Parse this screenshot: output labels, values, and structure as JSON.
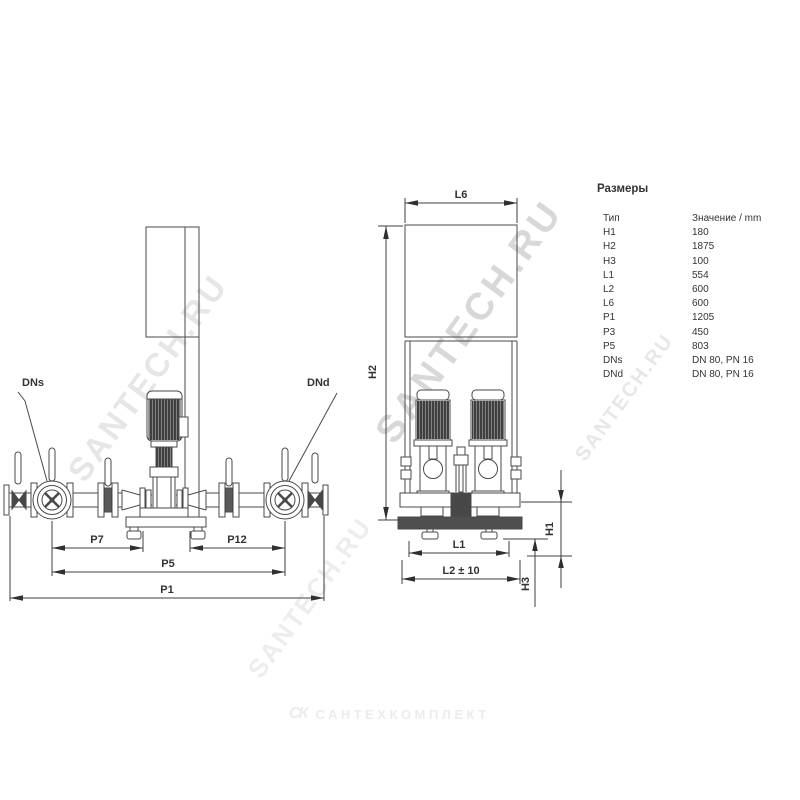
{
  "table": {
    "title": "Размеры",
    "col_type": "Тип",
    "col_value": "Значение / mm",
    "rows": [
      {
        "label": "H1",
        "value": "180"
      },
      {
        "label": "H2",
        "value": "1875"
      },
      {
        "label": "H3",
        "value": "100"
      },
      {
        "label": "L1",
        "value": "554"
      },
      {
        "label": "L2",
        "value": "600"
      },
      {
        "label": "L6",
        "value": "600"
      },
      {
        "label": "P1",
        "value": "1205"
      },
      {
        "label": "P3",
        "value": "450"
      },
      {
        "label": "P5",
        "value": "803"
      },
      {
        "label": "DNs",
        "value": "DN 80, PN 16"
      },
      {
        "label": "DNd",
        "value": "DN 80, PN 16"
      }
    ]
  },
  "front_view_labels": {
    "dns": "DNs",
    "dnd": "DNd",
    "p7": "P7",
    "p12": "P12",
    "p5": "P5",
    "p1": "P1"
  },
  "side_view_labels": {
    "l6": "L6",
    "h2": "H2",
    "h1": "H1",
    "h3": "H3",
    "l1": "L1",
    "l2": "L2 ± 10"
  },
  "watermarks": {
    "diagonal": "SANTECH.RU",
    "footer_icon": "СК",
    "footer_text": "САНТЕХКОМПЛЕКТ"
  },
  "colors": {
    "line": "#4a4a4a",
    "dark_fill": "#474747",
    "watermark": "#b2b2b2"
  }
}
